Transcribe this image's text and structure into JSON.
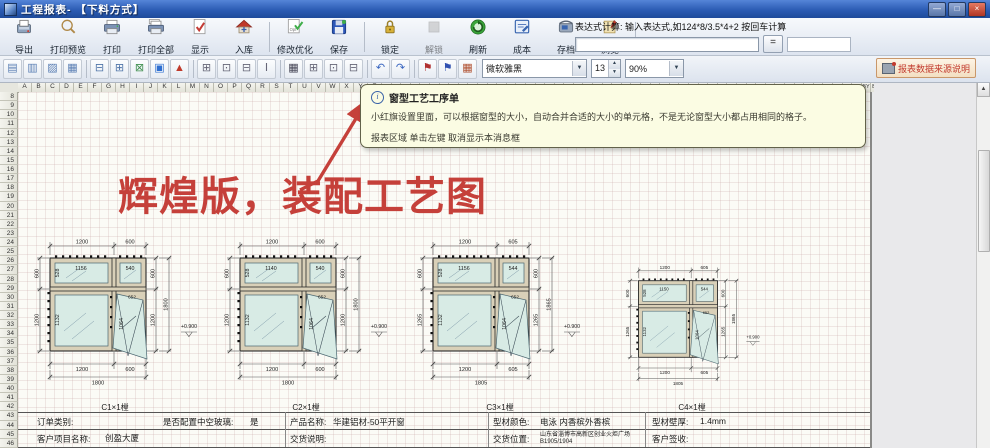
{
  "titlebar": {
    "title": "工程报表- 【下料方式】",
    "controls": {
      "minimize": "—",
      "maximize": "□",
      "close": "×"
    }
  },
  "toolbar_main": {
    "buttons": [
      {
        "label": "导出",
        "icon": "export-icon"
      },
      {
        "label": "打印预览",
        "icon": "print-preview-icon"
      },
      {
        "label": "打印",
        "icon": "print-icon"
      },
      {
        "label": "打印全部",
        "icon": "print-all-icon"
      },
      {
        "label": "显示",
        "icon": "display-icon"
      },
      {
        "label": "入库",
        "icon": "warehouse-icon",
        "group_end": true
      },
      {
        "label": "修改优化",
        "icon": "optimize-icon"
      },
      {
        "label": "保存",
        "icon": "save-icon",
        "group_end": true
      },
      {
        "label": "锁定",
        "icon": "lock-icon"
      },
      {
        "label": "解锁",
        "icon": "unlock-icon",
        "disabled": true
      },
      {
        "label": "刷新",
        "icon": "refresh-icon"
      },
      {
        "label": "成本",
        "icon": "cost-icon"
      },
      {
        "label": "存档",
        "icon": "archive-icon"
      },
      {
        "label": "浏览",
        "icon": "browse-icon",
        "group_end": true
      }
    ]
  },
  "expression": {
    "caption": "表达式计算: 输入表达式,如124*8/3.5*4+2  按回车计算",
    "input_value": "",
    "equals_label": "=",
    "result_value": ""
  },
  "toolbar_format": {
    "font_name": "微软雅黑",
    "font_size": "13",
    "zoom_level": "90%",
    "dropdown_arrow": "▼",
    "spin_up": "▲",
    "spin_down": "▼",
    "data_source_label": "报表数据来源说明",
    "small_buttons": [
      {
        "name": "align-left-icon",
        "glyph": "▤",
        "color": "#5b7fb4"
      },
      {
        "name": "align-center-icon",
        "glyph": "▥",
        "color": "#5b7fb4"
      },
      {
        "name": "align-right-icon",
        "glyph": "▨",
        "color": "#5b7fb4"
      },
      {
        "name": "fit-rows-icon",
        "glyph": "▦",
        "color": "#5b7fb4",
        "sep": true
      },
      {
        "name": "insert-sheet-icon",
        "glyph": "⊟",
        "color": "#4f74a8"
      },
      {
        "name": "page-setup-icon",
        "glyph": "⊞",
        "color": "#4f74a8"
      },
      {
        "name": "clear-cells-icon",
        "glyph": "⊠",
        "color": "#3f8f4f"
      },
      {
        "name": "select-region-icon",
        "glyph": "▣",
        "color": "#2f6fd0"
      },
      {
        "name": "flag-marker-icon",
        "glyph": "▲",
        "color": "#c03a2b",
        "sep": true
      },
      {
        "name": "merge-across-icon",
        "glyph": "⊞",
        "color": "#667"
      },
      {
        "name": "merge-down-icon",
        "glyph": "⊡",
        "color": "#667"
      },
      {
        "name": "split-cell-icon",
        "glyph": "⊟",
        "color": "#667"
      },
      {
        "name": "row-height-icon",
        "glyph": "Ⅰ",
        "color": "#667",
        "sep": true
      },
      {
        "name": "table-grid-icon",
        "glyph": "▦",
        "color": "#445"
      },
      {
        "name": "border-all-icon",
        "glyph": "⊞",
        "color": "#667"
      },
      {
        "name": "border-outer-icon",
        "glyph": "⊡",
        "color": "#667"
      },
      {
        "name": "border-inner-icon",
        "glyph": "⊟",
        "color": "#667",
        "sep": true
      },
      {
        "name": "undo-icon",
        "glyph": "↶",
        "color": "#3a66c0"
      },
      {
        "name": "redo-icon",
        "glyph": "↷",
        "color": "#3a66c0",
        "sep": true
      },
      {
        "name": "red-flag-icon",
        "glyph": "⚑",
        "color": "#b03030"
      },
      {
        "name": "blue-flag-icon",
        "glyph": "⚑",
        "color": "#3050b0"
      },
      {
        "name": "palette-icon",
        "glyph": "▦",
        "color": "#b05030"
      }
    ]
  },
  "sheet": {
    "column_letters": "ABCDEFGHIJKLMNOPQRSTUVWXYZ",
    "row_start": 8,
    "row_end": 46,
    "scroll_up_arrow": "▲"
  },
  "tooltip": {
    "title": "窗型工艺工序单",
    "line1": "小红旗设置里面，可以根据窗型的大小，自动合并合适的大小的单元格，不是无论窗型大小都占用相同的格子。",
    "line2": "报表区域 单击左键 取消显示本消息框"
  },
  "annotation": {
    "text": "辉煌版，装配工艺图"
  },
  "accent_colors": {
    "annotation_red": "#c5403a",
    "tooltip_bg": "#fbfce3",
    "glass": "#d8ebe5"
  },
  "drawings": [
    {
      "label": "C1×1樘",
      "dims": {
        "top": [
          "1200",
          "600"
        ],
        "left": [
          "600",
          "1200"
        ],
        "right": [
          "600",
          "1200"
        ],
        "height_total": "1800",
        "bottom": [
          "1200",
          "600"
        ],
        "width_total": "1800"
      },
      "panes": {
        "top_left_width": "1156",
        "top_left_height": "528",
        "top_right_width": "540",
        "bottom_left_height": "1132",
        "sash_height": "1064",
        "sash_width": "652"
      },
      "level_mark": "+0.900"
    },
    {
      "label": "C2×1樘",
      "dims": {
        "top": [
          "1200",
          "600"
        ],
        "left": [
          "600",
          "1200"
        ],
        "right": [
          "600",
          "1200"
        ],
        "height_total": "1800",
        "bottom": [
          "1200",
          "600"
        ],
        "width_total": "1800"
      },
      "panes": {
        "top_left_width": "1140",
        "top_left_height": "528",
        "top_right_width": "540",
        "bottom_left_height": "1132",
        "sash_height": "1064",
        "sash_width": "652"
      },
      "level_mark": "+0.900"
    },
    {
      "label": "C3×1樘",
      "dims": {
        "top": [
          "1200",
          "605"
        ],
        "left": [
          "600",
          "1265"
        ],
        "right": [
          "600",
          "1265"
        ],
        "height_total": "1865",
        "bottom": [
          "1200",
          "605"
        ],
        "width_total": "1805"
      },
      "panes": {
        "top_left_width": "1156",
        "top_left_height": "528",
        "top_right_width": "544",
        "bottom_left_height": "1132",
        "sash_height": "1064",
        "sash_width": "652"
      },
      "level_mark": "+0.900"
    },
    {
      "label": "C4×1樘",
      "dims": {
        "top": [
          "1200",
          "605"
        ],
        "left": [
          "600",
          "1265"
        ],
        "right": [
          "600",
          "1265"
        ],
        "height_total": "1865",
        "bottom": [
          "1200",
          "605"
        ],
        "width_total": "1805"
      },
      "panes": {
        "top_left_width": "1150",
        "top_left_height": "528",
        "top_right_width": "544",
        "bottom_left_height": "1132",
        "sash_height": "1064",
        "sash_width": "652"
      },
      "level_mark": "+0.900"
    }
  ],
  "order_table": {
    "unit_labels": [
      "C1×1樘",
      "C2×1樘",
      "C3×1樘",
      "C4×1樘"
    ],
    "row1": [
      {
        "label": "订单类别:",
        "value": ""
      },
      {
        "label": "是否配置中空玻璃:",
        "value": "是"
      },
      {
        "label": "产品名称:",
        "value": "华建铝材-50平开窗"
      },
      {
        "label": "型材颜色:",
        "value": "电泳 内香槟外香槟"
      },
      {
        "label": "型材壁厚:",
        "value": "1.4mm"
      }
    ],
    "row2": [
      {
        "label": "客户项目名称:",
        "value": "创盈大厦"
      },
      {
        "label": "交货说明:",
        "value": ""
      },
      {
        "label": "交货位置:",
        "value": "山东省淄博市高新区创业火炬广场B1905/1904"
      },
      {
        "label": "客户签收:",
        "value": ""
      }
    ]
  }
}
